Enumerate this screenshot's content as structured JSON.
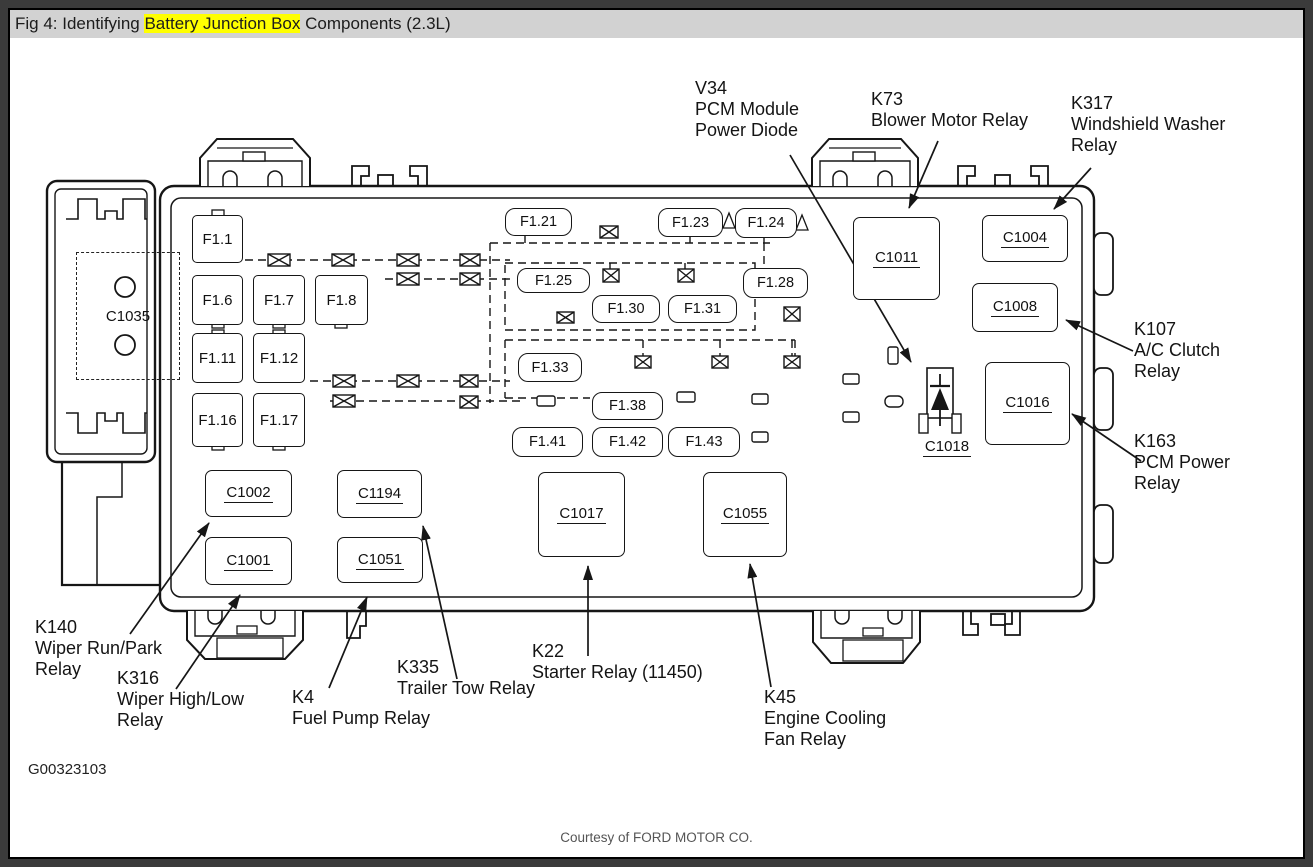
{
  "title": {
    "prefix": "Fig 4: Identifying ",
    "highlight": "Battery Junction Box",
    "suffix": " Components (2.3L)"
  },
  "fuses": {
    "f1_1": "F1.1",
    "f1_6": "F1.6",
    "f1_7": "F1.7",
    "f1_8": "F1.8",
    "f1_11": "F1.11",
    "f1_12": "F1.12",
    "f1_16": "F1.16",
    "f1_17": "F1.17",
    "f1_21": "F1.21",
    "f1_23": "F1.23",
    "f1_24": "F1.24",
    "f1_25": "F1.25",
    "f1_28": "F1.28",
    "f1_30": "F1.30",
    "f1_31": "F1.31",
    "f1_33": "F1.33",
    "f1_38": "F1.38",
    "f1_41": "F1.41",
    "f1_42": "F1.42",
    "f1_43": "F1.43"
  },
  "connectors": {
    "c1035": "C1035",
    "c1011": "C1011",
    "c1004": "C1004",
    "c1008": "C1008",
    "c1016": "C1016",
    "c1018": "C1018",
    "c1002": "C1002",
    "c1194": "C1194",
    "c1001": "C1001",
    "c1051": "C1051",
    "c1017": "C1017",
    "c1055": "C1055"
  },
  "callouts": {
    "v34": {
      "l1": "V34",
      "l2": "PCM Module",
      "l3": "Power Diode"
    },
    "k73": {
      "l1": "K73",
      "l2": "Blower Motor Relay"
    },
    "k317": {
      "l1": "K317",
      "l2": "Windshield Washer",
      "l3": "Relay"
    },
    "k107": {
      "l1": "K107",
      "l2": "A/C Clutch",
      "l3": "Relay"
    },
    "k163": {
      "l1": "K163",
      "l2": "PCM Power",
      "l3": "Relay"
    },
    "k140": {
      "l1": "K140",
      "l2": "Wiper Run/Park",
      "l3": "Relay"
    },
    "k316": {
      "l1": "K316",
      "l2": "Wiper High/Low",
      "l3": "Relay"
    },
    "k4": {
      "l1": "K4",
      "l2": "Fuel Pump Relay"
    },
    "k335": {
      "l1": "K335",
      "l2": "Trailer Tow Relay"
    },
    "k22": {
      "l1": "K22",
      "l2": "Starter Relay (11450)"
    },
    "k45": {
      "l1": "K45",
      "l2": "Engine Cooling",
      "l3": "Fan Relay"
    }
  },
  "figure_id": "G00323103",
  "courtesy": "Courtesy of FORD MOTOR CO.",
  "colors": {
    "highlight": "#ffff00",
    "titlebar_bg": "#d2d2d2",
    "frame": "#3b3b3b",
    "line": "#161616"
  }
}
